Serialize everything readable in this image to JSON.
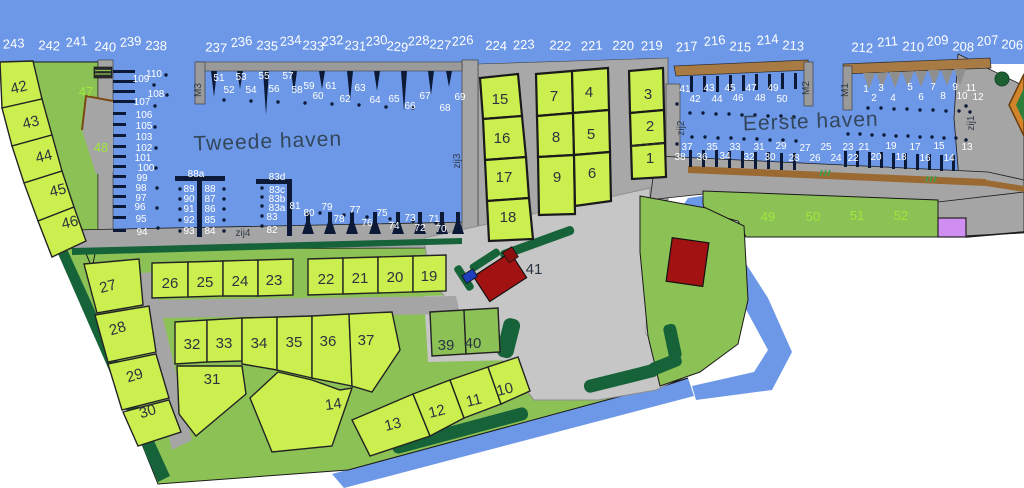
{
  "map_title": "Marina plattegrond",
  "titles": [
    {
      "t": "Tweede haven",
      "x": 268,
      "y": 148,
      "r": -2
    },
    {
      "t": "Eerste haven",
      "x": 811,
      "y": 128,
      "r": -2
    }
  ],
  "colors": {
    "water": "#6d98e8",
    "plot_yellow": "#cbef4e",
    "land_green": "#8cc155",
    "hedge_green": "#176339",
    "quay_gray": "#a5a5a5",
    "parking_gray": "#c6c6c6",
    "pier_dark": "#0c1a38",
    "building_red": "#a31212",
    "quay_brown": "#9b6a33",
    "purple_plot": "#d18ef2",
    "green_label": "#9fe83a"
  },
  "labels": {
    "sea_numbers": [
      {
        "t": "243",
        "x": 14,
        "y": 48,
        "r": -4
      },
      {
        "t": "242",
        "x": 49,
        "y": 50,
        "r": 3
      },
      {
        "t": "241",
        "x": 77,
        "y": 46,
        "r": -5
      },
      {
        "t": "240",
        "x": 105,
        "y": 51,
        "r": 4
      },
      {
        "t": "239",
        "x": 131,
        "y": 46,
        "r": -6
      },
      {
        "t": "238",
        "x": 156,
        "y": 50,
        "r": 2
      },
      {
        "t": "237",
        "x": 216,
        "y": 52,
        "r": 3
      },
      {
        "t": "236",
        "x": 242,
        "y": 46,
        "r": -7
      },
      {
        "t": "235",
        "x": 267,
        "y": 50,
        "r": 3
      },
      {
        "t": "234",
        "x": 291,
        "y": 45,
        "r": -6
      },
      {
        "t": "233",
        "x": 313,
        "y": 50,
        "r": 4
      },
      {
        "t": "232",
        "x": 333,
        "y": 45,
        "r": -5
      },
      {
        "t": "231",
        "x": 355,
        "y": 50,
        "r": 4
      },
      {
        "t": "230",
        "x": 377,
        "y": 45,
        "r": -5
      },
      {
        "t": "229",
        "x": 397,
        "y": 51,
        "r": 5
      },
      {
        "t": "228",
        "x": 419,
        "y": 45,
        "r": -4
      },
      {
        "t": "227",
        "x": 440,
        "y": 49,
        "r": 4
      },
      {
        "t": "226",
        "x": 463,
        "y": 45,
        "r": -5
      },
      {
        "t": "224",
        "x": 496,
        "y": 50,
        "r": 2
      },
      {
        "t": "223",
        "x": 524,
        "y": 49,
        "r": -3
      },
      {
        "t": "222",
        "x": 560,
        "y": 50,
        "r": 3
      },
      {
        "t": "221",
        "x": 592,
        "y": 50,
        "r": -3
      },
      {
        "t": "220",
        "x": 623,
        "y": 50,
        "r": 2
      },
      {
        "t": "219",
        "x": 652,
        "y": 50,
        "r": -2
      },
      {
        "t": "217",
        "x": 687,
        "y": 51,
        "r": -3
      },
      {
        "t": "216",
        "x": 715,
        "y": 45,
        "r": -5
      },
      {
        "t": "215",
        "x": 740,
        "y": 51,
        "r": 4
      },
      {
        "t": "214",
        "x": 768,
        "y": 44,
        "r": -5
      },
      {
        "t": "213",
        "x": 793,
        "y": 50,
        "r": 3
      },
      {
        "t": "212",
        "x": 862,
        "y": 52,
        "r": 3
      },
      {
        "t": "211",
        "x": 888,
        "y": 46,
        "r": -5
      },
      {
        "t": "210",
        "x": 913,
        "y": 51,
        "r": 3
      },
      {
        "t": "209",
        "x": 938,
        "y": 45,
        "r": -5
      },
      {
        "t": "208",
        "x": 963,
        "y": 51,
        "r": 3
      },
      {
        "t": "207",
        "x": 988,
        "y": 45,
        "r": -5
      },
      {
        "t": "206",
        "x": 1012,
        "y": 49,
        "r": 3
      }
    ],
    "west_wall_berths": [
      {
        "t": "110",
        "x": 154,
        "y": 77
      },
      {
        "t": "109",
        "x": 141,
        "y": 82
      },
      {
        "t": "108",
        "x": 156,
        "y": 97
      },
      {
        "t": "107",
        "x": 142,
        "y": 105
      },
      {
        "t": "106",
        "x": 144,
        "y": 118
      },
      {
        "t": "105",
        "x": 144,
        "y": 129
      },
      {
        "t": "103",
        "x": 144,
        "y": 140
      },
      {
        "t": "102",
        "x": 144,
        "y": 151
      },
      {
        "t": "101",
        "x": 143,
        "y": 161
      },
      {
        "t": "100",
        "x": 146,
        "y": 171
      },
      {
        "t": "99",
        "x": 142,
        "y": 181
      },
      {
        "t": "98",
        "x": 141,
        "y": 191
      },
      {
        "t": "97",
        "x": 141,
        "y": 201
      },
      {
        "t": "96",
        "x": 140,
        "y": 210
      },
      {
        "t": "95",
        "x": 141,
        "y": 222
      },
      {
        "t": "94",
        "x": 142,
        "y": 235
      }
    ],
    "m3_berths": [
      {
        "t": "51",
        "x": 219,
        "y": 81
      },
      {
        "t": "52",
        "x": 229,
        "y": 93
      },
      {
        "t": "53",
        "x": 241,
        "y": 80
      },
      {
        "t": "54",
        "x": 251,
        "y": 93
      },
      {
        "t": "55",
        "x": 264,
        "y": 79
      },
      {
        "t": "56",
        "x": 274,
        "y": 92
      },
      {
        "t": "57",
        "x": 288,
        "y": 79
      },
      {
        "t": "58",
        "x": 297,
        "y": 93
      },
      {
        "t": "59",
        "x": 309,
        "y": 89
      },
      {
        "t": "60",
        "x": 318,
        "y": 99
      },
      {
        "t": "61",
        "x": 331,
        "y": 89
      },
      {
        "t": "62",
        "x": 345,
        "y": 102
      },
      {
        "t": "63",
        "x": 360,
        "y": 91
      },
      {
        "t": "64",
        "x": 375,
        "y": 103
      },
      {
        "t": "65",
        "x": 394,
        "y": 102
      },
      {
        "t": "66",
        "x": 410,
        "y": 109
      },
      {
        "t": "67",
        "x": 425,
        "y": 99
      },
      {
        "t": "68",
        "x": 445,
        "y": 111
      },
      {
        "t": "69",
        "x": 460,
        "y": 100
      }
    ],
    "pier_88a": [
      {
        "t": "88a",
        "x": 196,
        "y": 177
      },
      {
        "t": "89",
        "x": 189,
        "y": 192
      },
      {
        "t": "90",
        "x": 189,
        "y": 202
      },
      {
        "t": "91",
        "x": 189,
        "y": 212
      },
      {
        "t": "92",
        "x": 189,
        "y": 223
      },
      {
        "t": "93",
        "x": 189,
        "y": 234
      },
      {
        "t": "88",
        "x": 210,
        "y": 192
      },
      {
        "t": "87",
        "x": 210,
        "y": 202
      },
      {
        "t": "86",
        "x": 210,
        "y": 212
      },
      {
        "t": "85",
        "x": 210,
        "y": 223
      },
      {
        "t": "84",
        "x": 210,
        "y": 234
      }
    ],
    "pier_83d": [
      {
        "t": "83d",
        "x": 277,
        "y": 180
      },
      {
        "t": "83c",
        "x": 277,
        "y": 193
      },
      {
        "t": "83b",
        "x": 277,
        "y": 202
      },
      {
        "t": "83a",
        "x": 277,
        "y": 211
      },
      {
        "t": "83",
        "x": 272,
        "y": 220
      },
      {
        "t": "82",
        "x": 272,
        "y": 233
      }
    ],
    "south_tweede_berths": [
      {
        "t": "81",
        "x": 295,
        "y": 209
      },
      {
        "t": "80",
        "x": 309,
        "y": 216
      },
      {
        "t": "79",
        "x": 327,
        "y": 210
      },
      {
        "t": "78",
        "x": 339,
        "y": 222
      },
      {
        "t": "77",
        "x": 355,
        "y": 213
      },
      {
        "t": "76",
        "x": 367,
        "y": 226
      },
      {
        "t": "75",
        "x": 382,
        "y": 216
      },
      {
        "t": "74",
        "x": 394,
        "y": 229
      },
      {
        "t": "73",
        "x": 410,
        "y": 221
      },
      {
        "t": "72",
        "x": 420,
        "y": 231
      },
      {
        "t": "71",
        "x": 434,
        "y": 222
      },
      {
        "t": "70",
        "x": 441,
        "y": 232
      }
    ],
    "eerste_north_berths": [
      {
        "t": "41",
        "x": 685,
        "y": 92
      },
      {
        "t": "42",
        "x": 695,
        "y": 102
      },
      {
        "t": "43",
        "x": 709,
        "y": 91
      },
      {
        "t": "44",
        "x": 717,
        "y": 102
      },
      {
        "t": "45",
        "x": 730,
        "y": 91
      },
      {
        "t": "46",
        "x": 738,
        "y": 101
      },
      {
        "t": "47",
        "x": 751,
        "y": 91
      },
      {
        "t": "48",
        "x": 760,
        "y": 101
      },
      {
        "t": "49",
        "x": 773,
        "y": 91
      },
      {
        "t": "50",
        "x": 782,
        "y": 102
      }
    ],
    "eerste_south_berths": [
      {
        "t": "38",
        "x": 680,
        "y": 160
      },
      {
        "t": "37",
        "x": 687,
        "y": 150
      },
      {
        "t": "36",
        "x": 702,
        "y": 160
      },
      {
        "t": "35",
        "x": 712,
        "y": 150
      },
      {
        "t": "34",
        "x": 725,
        "y": 159
      },
      {
        "t": "33",
        "x": 735,
        "y": 150
      },
      {
        "t": "32",
        "x": 749,
        "y": 160
      },
      {
        "t": "31",
        "x": 759,
        "y": 150
      },
      {
        "t": "30",
        "x": 770,
        "y": 160
      },
      {
        "t": "29",
        "x": 781,
        "y": 149
      },
      {
        "t": "28",
        "x": 794,
        "y": 161
      },
      {
        "t": "27",
        "x": 805,
        "y": 151
      },
      {
        "t": "26",
        "x": 815,
        "y": 161
      },
      {
        "t": "25",
        "x": 826,
        "y": 150
      },
      {
        "t": "24",
        "x": 836,
        "y": 161
      },
      {
        "t": "23",
        "x": 848,
        "y": 150
      },
      {
        "t": "22",
        "x": 853,
        "y": 161
      },
      {
        "t": "21",
        "x": 864,
        "y": 150
      },
      {
        "t": "20",
        "x": 876,
        "y": 160
      },
      {
        "t": "19",
        "x": 891,
        "y": 149
      },
      {
        "t": "18",
        "x": 901,
        "y": 160
      },
      {
        "t": "17",
        "x": 915,
        "y": 150
      },
      {
        "t": "16",
        "x": 925,
        "y": 161
      },
      {
        "t": "15",
        "x": 939,
        "y": 149
      },
      {
        "t": "14",
        "x": 949,
        "y": 161
      },
      {
        "t": "13",
        "x": 967,
        "y": 150
      }
    ],
    "m1_berths": [
      {
        "t": "1",
        "x": 866,
        "y": 92
      },
      {
        "t": "2",
        "x": 874,
        "y": 101
      },
      {
        "t": "3",
        "x": 881,
        "y": 91
      },
      {
        "t": "4",
        "x": 893,
        "y": 101
      },
      {
        "t": "5",
        "x": 910,
        "y": 90
      },
      {
        "t": "6",
        "x": 921,
        "y": 100
      },
      {
        "t": "7",
        "x": 933,
        "y": 90
      },
      {
        "t": "8",
        "x": 943,
        "y": 99
      },
      {
        "t": "9",
        "x": 955,
        "y": 90
      },
      {
        "t": "10",
        "x": 962,
        "y": 99
      },
      {
        "t": "11",
        "x": 971,
        "y": 91
      },
      {
        "t": "12",
        "x": 978,
        "y": 100
      }
    ],
    "green_plots": [
      {
        "t": "47",
        "x": 86,
        "y": 96
      },
      {
        "t": "48",
        "x": 101,
        "y": 152
      },
      {
        "t": "49",
        "x": 768,
        "y": 221
      },
      {
        "t": "50",
        "x": 813,
        "y": 221
      },
      {
        "t": "51",
        "x": 857,
        "y": 220
      },
      {
        "t": "52",
        "x": 901,
        "y": 220
      }
    ],
    "land_plots": [
      {
        "t": "42",
        "x": 20,
        "y": 92,
        "r": -14
      },
      {
        "t": "43",
        "x": 32,
        "y": 127,
        "r": -14
      },
      {
        "t": "44",
        "x": 45,
        "y": 161,
        "r": -14
      },
      {
        "t": "45",
        "x": 59,
        "y": 195,
        "r": -14
      },
      {
        "t": "46",
        "x": 71,
        "y": 227,
        "r": -14
      },
      {
        "t": "15",
        "x": 500,
        "y": 104
      },
      {
        "t": "16",
        "x": 502,
        "y": 143
      },
      {
        "t": "17",
        "x": 504,
        "y": 182
      },
      {
        "t": "18",
        "x": 508,
        "y": 222
      },
      {
        "t": "7",
        "x": 554,
        "y": 101
      },
      {
        "t": "4",
        "x": 589,
        "y": 97
      },
      {
        "t": "8",
        "x": 556,
        "y": 142
      },
      {
        "t": "5",
        "x": 591,
        "y": 139
      },
      {
        "t": "9",
        "x": 557,
        "y": 182
      },
      {
        "t": "6",
        "x": 592,
        "y": 178
      },
      {
        "t": "3",
        "x": 648,
        "y": 99
      },
      {
        "t": "2",
        "x": 650,
        "y": 131
      },
      {
        "t": "1",
        "x": 650,
        "y": 163
      },
      {
        "t": "27",
        "x": 109,
        "y": 291,
        "r": -14
      },
      {
        "t": "28",
        "x": 119,
        "y": 333,
        "r": -17
      },
      {
        "t": "29",
        "x": 136,
        "y": 380,
        "r": -17
      },
      {
        "t": "30",
        "x": 149,
        "y": 416,
        "r": -17
      },
      {
        "t": "26",
        "x": 170,
        "y": 288
      },
      {
        "t": "25",
        "x": 205,
        "y": 287
      },
      {
        "t": "24",
        "x": 240,
        "y": 286
      },
      {
        "t": "23",
        "x": 274,
        "y": 285
      },
      {
        "t": "22",
        "x": 326,
        "y": 284
      },
      {
        "t": "21",
        "x": 360,
        "y": 283
      },
      {
        "t": "20",
        "x": 395,
        "y": 282
      },
      {
        "t": "19",
        "x": 429,
        "y": 281
      },
      {
        "t": "32",
        "x": 192,
        "y": 349
      },
      {
        "t": "33",
        "x": 224,
        "y": 348
      },
      {
        "t": "34",
        "x": 259,
        "y": 348
      },
      {
        "t": "35",
        "x": 294,
        "y": 347
      },
      {
        "t": "36",
        "x": 328,
        "y": 346
      },
      {
        "t": "37",
        "x": 366,
        "y": 345
      },
      {
        "t": "31",
        "x": 212,
        "y": 384
      },
      {
        "t": "14",
        "x": 334,
        "y": 409,
        "r": -8
      },
      {
        "t": "13",
        "x": 394,
        "y": 429,
        "r": -14
      },
      {
        "t": "12",
        "x": 438,
        "y": 416,
        "r": -14
      },
      {
        "t": "11",
        "x": 475,
        "y": 405,
        "r": -14
      },
      {
        "t": "10",
        "x": 506,
        "y": 394,
        "r": -14
      },
      {
        "t": "39",
        "x": 446,
        "y": 350
      },
      {
        "t": "40",
        "x": 473,
        "y": 348
      },
      {
        "t": "41",
        "x": 534,
        "y": 274
      }
    ],
    "markers": [
      {
        "t": "zij4",
        "x": 243,
        "y": 236
      },
      {
        "t": "zij3",
        "x": 460,
        "y": 161,
        "r": -90
      },
      {
        "t": "zij2",
        "x": 684,
        "y": 128,
        "r": -90
      },
      {
        "t": "zij1",
        "x": 974,
        "y": 123,
        "r": -90
      },
      {
        "t": "M3",
        "x": 201,
        "y": 90,
        "r": -90
      },
      {
        "t": "M2",
        "x": 809,
        "y": 88,
        "r": -90
      },
      {
        "t": "M1",
        "x": 848,
        "y": 90,
        "r": -90
      }
    ]
  },
  "moorings": [
    [
      224,
      100
    ],
    [
      251,
      101
    ],
    [
      278,
      102
    ],
    [
      305,
      103
    ],
    [
      332,
      104
    ],
    [
      359,
      105
    ],
    [
      386,
      107
    ],
    [
      413,
      108
    ],
    [
      154,
      85
    ],
    [
      155,
      106
    ],
    [
      155,
      127
    ],
    [
      156,
      148
    ],
    [
      156,
      168
    ],
    [
      157,
      188
    ],
    [
      157,
      208
    ],
    [
      158,
      228
    ],
    [
      166,
      75
    ],
    [
      167,
      95
    ],
    [
      180,
      189
    ],
    [
      180,
      199
    ],
    [
      180,
      209
    ],
    [
      180,
      220
    ],
    [
      180,
      231
    ],
    [
      224,
      189
    ],
    [
      224,
      199
    ],
    [
      224,
      209
    ],
    [
      224,
      220
    ],
    [
      224,
      231
    ],
    [
      262,
      188
    ],
    [
      262,
      197
    ],
    [
      262,
      206
    ],
    [
      262,
      216
    ],
    [
      262,
      226
    ],
    [
      320,
      213
    ],
    [
      344,
      215
    ],
    [
      367,
      217
    ],
    [
      390,
      219
    ],
    [
      413,
      221
    ],
    [
      436,
      223
    ],
    [
      690,
      113
    ],
    [
      703,
      113
    ],
    [
      716,
      114
    ],
    [
      729,
      114
    ],
    [
      742,
      115
    ],
    [
      755,
      115
    ],
    [
      768,
      116
    ],
    [
      781,
      116
    ],
    [
      794,
      117
    ],
    [
      692,
      137
    ],
    [
      705,
      137
    ],
    [
      718,
      138
    ],
    [
      731,
      138
    ],
    [
      744,
      139
    ],
    [
      757,
      139
    ],
    [
      770,
      140
    ],
    [
      783,
      140
    ],
    [
      796,
      141
    ],
    [
      868,
      108
    ],
    [
      881,
      108
    ],
    [
      894,
      109
    ],
    [
      907,
      109
    ],
    [
      920,
      110
    ],
    [
      933,
      110
    ],
    [
      946,
      111
    ],
    [
      959,
      111
    ],
    [
      970,
      112
    ],
    [
      848,
      134
    ],
    [
      860,
      134
    ],
    [
      872,
      135
    ],
    [
      884,
      135
    ],
    [
      896,
      136
    ],
    [
      908,
      136
    ],
    [
      920,
      137
    ],
    [
      932,
      137
    ],
    [
      944,
      138
    ],
    [
      956,
      138
    ],
    [
      677,
      104
    ],
    [
      677,
      144
    ],
    [
      966,
      106
    ],
    [
      966,
      140
    ]
  ]
}
